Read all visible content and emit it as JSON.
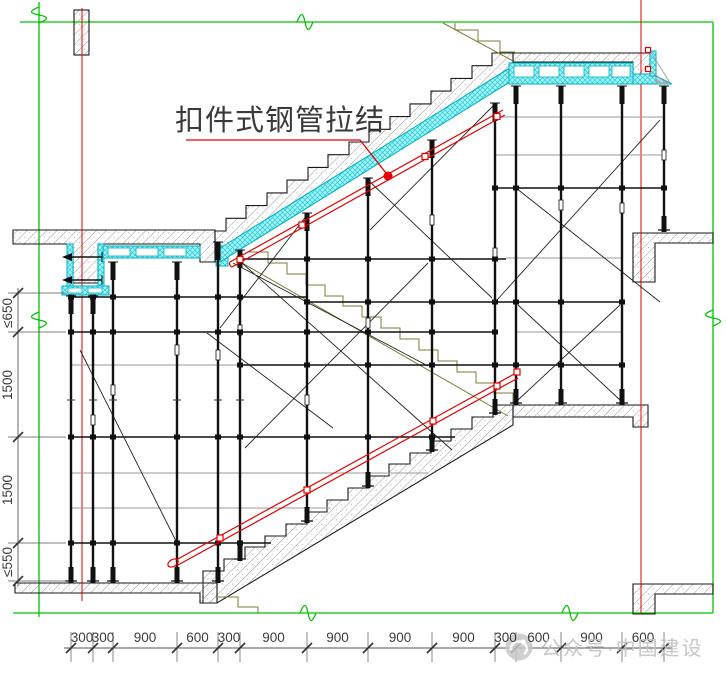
{
  "callout": {
    "label": "扣件式钢管拉结"
  },
  "dimensions": {
    "bottom": [
      "300",
      "300",
      "900",
      "600",
      "300",
      "900",
      "900",
      "900",
      "900",
      "300",
      "600",
      "900",
      "600"
    ],
    "left": [
      "≤650",
      "1500",
      "1500",
      "≤550"
    ]
  },
  "watermark": {
    "text": "公众号·中国建设",
    "icon": "official-account-logo"
  },
  "colors": {
    "axis_green": "#00c300",
    "axis_red": "#dd0000",
    "tie_red": "#e60000",
    "formwork_cyan": "#00b2c2",
    "adjacent_flight_olive": "#7b7b35",
    "concrete_hatch_gray": "#8a8a8a",
    "watermark_gray": "#c2c2c2"
  }
}
